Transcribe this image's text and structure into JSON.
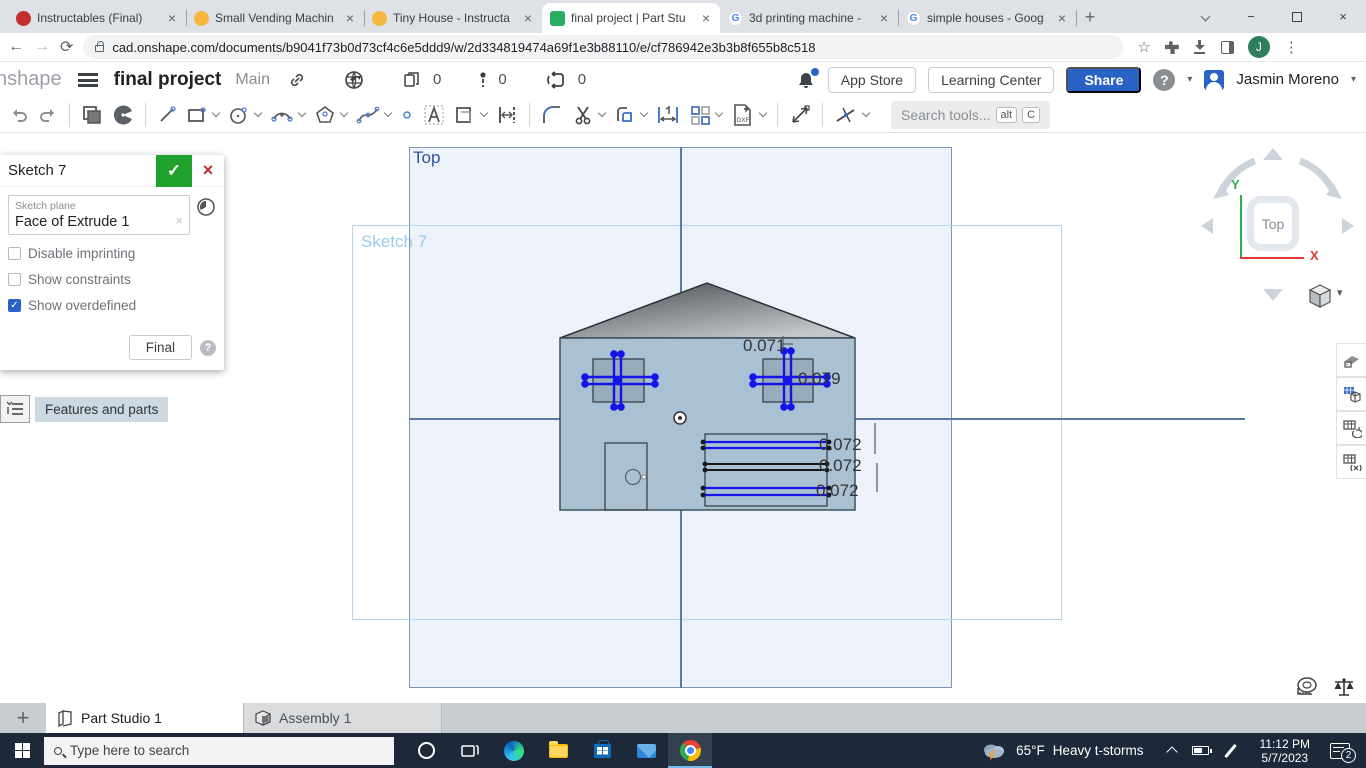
{
  "icons": {
    "close": "×",
    "plus": "+",
    "minus": "−",
    "check": "✓",
    "question": "?",
    "kebab": "⋮",
    "star": "☆",
    "caret_down": "▾",
    "back": "←",
    "forward": "→",
    "reload": "⟳",
    "dxf": "DXF"
  },
  "browser": {
    "tabs": [
      {
        "title": "Instructables (Final)"
      },
      {
        "title": "Small Vending Machin"
      },
      {
        "title": "Tiny House - Instructa"
      },
      {
        "title": "final project | Part Stu"
      },
      {
        "title": "3d printing machine -"
      },
      {
        "title": "simple houses - Goog"
      }
    ],
    "url": "cad.onshape.com/documents/b9041f73b0d73cf4c6e5ddd9/w/2d334819474a69f1e3b88110/e/cf786942e3b3b8f655b8c518",
    "avatar_letter": "J",
    "google_letter": "G"
  },
  "onshape_header": {
    "logo_text": "nshape",
    "doc_title": "final project",
    "workspace": "Main",
    "copies_count": "0",
    "alerts_count": "0",
    "forks_count": "0",
    "app_store_label": "App Store",
    "learning_center_label": "Learning Center",
    "share_label": "Share",
    "user_name": "Jasmin Moreno"
  },
  "toolbar": {
    "search_placeholder": "Search tools...",
    "shortcut_alt": "alt",
    "shortcut_c": "C"
  },
  "sketch_dialog": {
    "title": "Sketch 7",
    "plane_label": "Sketch plane",
    "plane_value": "Face of Extrude 1",
    "checkboxes": [
      {
        "label": "Disable imprinting",
        "checked": false
      },
      {
        "label": "Show constraints",
        "checked": false
      },
      {
        "label": "Show overdefined",
        "checked": true
      }
    ],
    "final_label": "Final"
  },
  "features_button_label": "Features and parts",
  "canvas": {
    "plane_label": "Top",
    "sketch_label": "Sketch 7",
    "dims": {
      "d1": "0.071",
      "d2": "0.079",
      "d3": "0.072",
      "d4": "0.072",
      "d5": "0.072"
    }
  },
  "view_cube": {
    "face": "Top",
    "axis_x": "X",
    "axis_y": "Y"
  },
  "doc_tabs": [
    {
      "label": "Part Studio 1",
      "active": true
    },
    {
      "label": "Assembly 1",
      "active": false
    }
  ],
  "taskbar": {
    "search_placeholder": "Type here to search",
    "weather_temp": "65°F",
    "weather_desc": "Heavy t-storms",
    "time": "11:12 PM",
    "date": "5/7/2023",
    "notification_count": "2"
  },
  "colors": {
    "share_blue": "#2a63c5",
    "confirm_green": "#21a12e",
    "cancel_red": "#c02c2c",
    "sketch_blue": "#1414e8",
    "overdefined_blue": "#2a63c5",
    "plane_border": "#7e95bd",
    "taskbar_bg": "#1d2938"
  }
}
